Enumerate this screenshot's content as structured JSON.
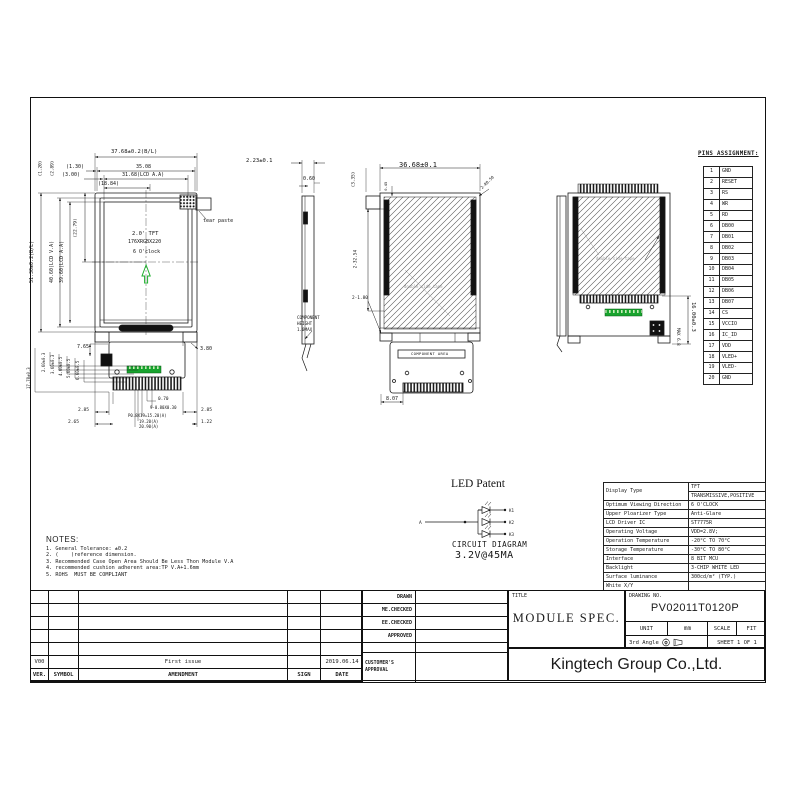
{
  "page": {
    "bg": "#ffffff",
    "ink": "#1a1a1a",
    "accent_green": "#18a32e"
  },
  "pins": {
    "title": "PINS ASSIGNMENT:",
    "rows": [
      [
        "1",
        "GND"
      ],
      [
        "2",
        "RESET"
      ],
      [
        "3",
        "RS"
      ],
      [
        "4",
        "WR"
      ],
      [
        "5",
        "RD"
      ],
      [
        "6",
        "DB00"
      ],
      [
        "7",
        "DB01"
      ],
      [
        "8",
        "DB02"
      ],
      [
        "9",
        "DB03"
      ],
      [
        "10",
        "DB04"
      ],
      [
        "11",
        "DB05"
      ],
      [
        "12",
        "DB06"
      ],
      [
        "13",
        "DB07"
      ],
      [
        "14",
        "CS"
      ],
      [
        "15",
        "VCCIO"
      ],
      [
        "16",
        "IC_ID"
      ],
      [
        "17",
        "VDD"
      ],
      [
        "18",
        "VLED+"
      ],
      [
        "19",
        "VLED-"
      ],
      [
        "20",
        "GND"
      ]
    ]
  },
  "specs": {
    "display_type_label": "Display Type",
    "display_type_value1": "TFT",
    "display_type_value2": "TRANSMISSIVE,POSITIVE",
    "rows": [
      [
        "Optimum Viewing Direction",
        "6 O'CLOCK"
      ],
      [
        "Upper Ploarizer Type",
        "Anti-Glare"
      ],
      [
        "LCD Driver IC",
        "ST7775R"
      ],
      [
        "Operating Voltage",
        "VDD=2.8V;"
      ],
      [
        "Operation Temperature",
        "-20°C TO 70°C"
      ],
      [
        "Storage Temperature",
        "-30°C TO 80°C"
      ],
      [
        "Interface",
        "8 BIT MCU"
      ],
      [
        "Backlight",
        "3-CHIP WHITE LED"
      ],
      [
        "Surface luminance",
        "300cd/m² (TYP.)"
      ],
      [
        "White X/Y",
        ""
      ]
    ]
  },
  "notes": {
    "title": "NOTES:",
    "items": [
      "1. General Tolerance: ±0.2",
      "2. (    )reference dimension.",
      "3. Recommended Case Open Area Should Be Less Thon Module V.A",
      "4. recommended cushion adherent area:TP V.A+1.6mm",
      "5. ROHS  MUST BE COMPLIANT"
    ]
  },
  "led": {
    "title": "LED Patent",
    "caption1": "CIRCUIT DIAGRAM",
    "caption2": "3.2V@45MA",
    "anode_label": "A",
    "cathode_labels": [
      "K1",
      "K2",
      "K3"
    ]
  },
  "title_block": {
    "title_label": "TITLE",
    "title": "MODULE SPEC.",
    "drawing_no_label": "DRAWING NO.",
    "drawing_no": "PV02011T0120P",
    "unit_label": "UNIT",
    "unit_value": "mm",
    "scale_label": "SCALE",
    "scale_value": "FIT",
    "angle_label": "3rd Angle",
    "sheet_label": "SHEET 1 OF 1",
    "company": "Kingtech Group Co.,Ltd."
  },
  "approval": {
    "rows": [
      "DRAWN",
      "ME.CHECKED",
      "EE.CHECKED",
      "APPROVED"
    ],
    "customer_line1": "CUSTOMER'S",
    "customer_line2": "APPROVAL"
  },
  "revision": {
    "rows": [
      [
        "",
        "",
        "",
        "",
        ""
      ],
      [
        "",
        "",
        "",
        "",
        ""
      ],
      [
        "",
        "",
        "",
        "",
        ""
      ],
      [
        "",
        "",
        "",
        "",
        ""
      ],
      [
        "",
        "",
        "",
        "",
        ""
      ],
      [
        "V00",
        "",
        "First issue",
        "",
        "2019.06.14"
      ],
      [
        "VER.",
        "SYMBOL",
        "AMENDMENT",
        "SIGN",
        "DATE"
      ]
    ]
  },
  "views": {
    "front": {
      "screen": [
        "2.0' TFT",
        "176XRGBX220",
        "6 O'clock"
      ],
      "tear_paste_label": "tear paste",
      "dims": {
        "top1": "37.68±0.2(B/L)",
        "top2": "35.08",
        "top3": "31.68(LCD A.A)",
        "top4": "(18.84)",
        "off1": "(1.30)",
        "off2": "(3.00)",
        "rot1": "(1.20)",
        "rot2": "(2.89)",
        "left1": "51.30±0.2(B/L)",
        "left2": "40.60(LCD V.A)",
        "left3": "39.60(LCD A.A)",
        "left4": "(22.79)",
        "right1": "3.80",
        "left_small": "7.65",
        "b1": "2.85",
        "b2": "2.65",
        "b3": "2.85",
        "b4": "1.22",
        "c1": "0.70",
        "c2": "9-0.80X0.30",
        "c3": "P0.8X19=15.20(A)",
        "c4": "19.20(A)",
        "c5": "20.90(A)",
        "r1": "17.78±0.3",
        "r2": "2.60±0.3",
        "r3": "3.60±0.3",
        "r4": "4.60±0.5",
        "r5": "5.60±0.5",
        "r6": "6.60±0.5"
      }
    },
    "side": {
      "d1": "2.23±0.1",
      "d2": "0.60",
      "note": [
        "COMPONENT",
        "HEIGHT",
        "1.0MAX"
      ]
    },
    "rear": {
      "top": "36.68±0.1",
      "rot1": "(3.35)",
      "rot2": "0.45",
      "left": "2-32.54",
      "corner": "2-R0.50",
      "bottom_left": "2-1.80",
      "component_area": "COMPONENT AREA",
      "b1": "8.07",
      "tape": "double side tape"
    },
    "folded": {
      "right": "16.00±0.3",
      "max": "MAX 6.8",
      "tape": "double side tape"
    }
  }
}
